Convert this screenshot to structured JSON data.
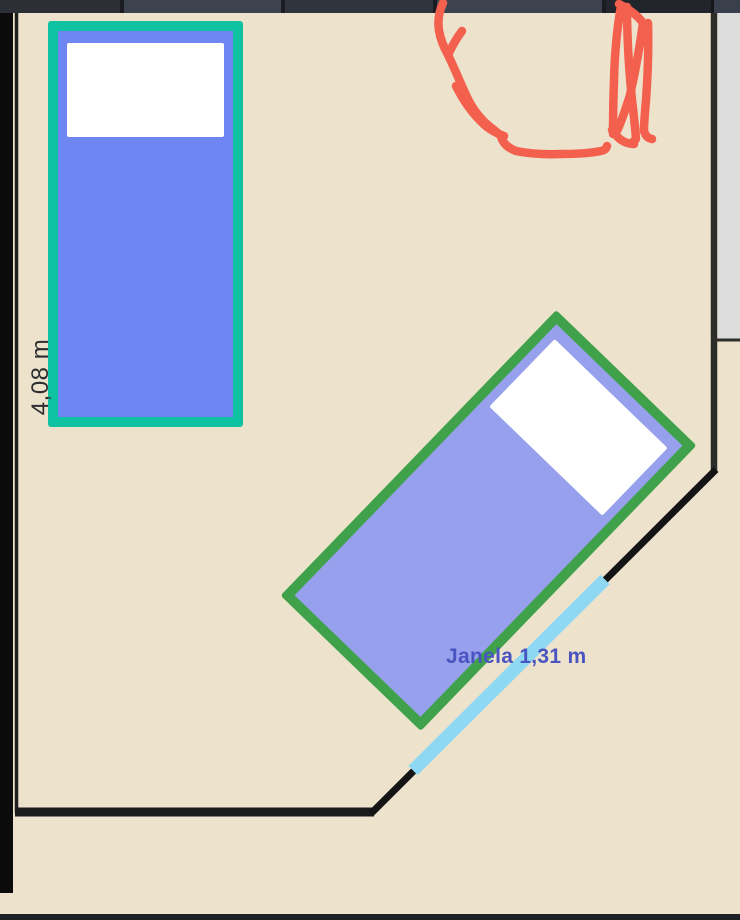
{
  "canvas": {
    "wall_dimension_label": "4,08 m",
    "window_label": "Janela 1,31 m"
  },
  "colors": {
    "floor": "#ede3cd",
    "outside_gray": "#dcdddc",
    "wall": "#1b1b1b",
    "window": "#8fd8f3",
    "window_label_text": "#4a54c0",
    "dimension_text": "#2e2e30",
    "annotation_red": "#f4604e",
    "bed_vertical_fill": "#6d86f2",
    "bed_vertical_border": "#0fc2a1",
    "bed_rotated_fill": "#97a0ec",
    "bed_rotated_border": "#3fa24b",
    "pillow": "#ffffff"
  }
}
